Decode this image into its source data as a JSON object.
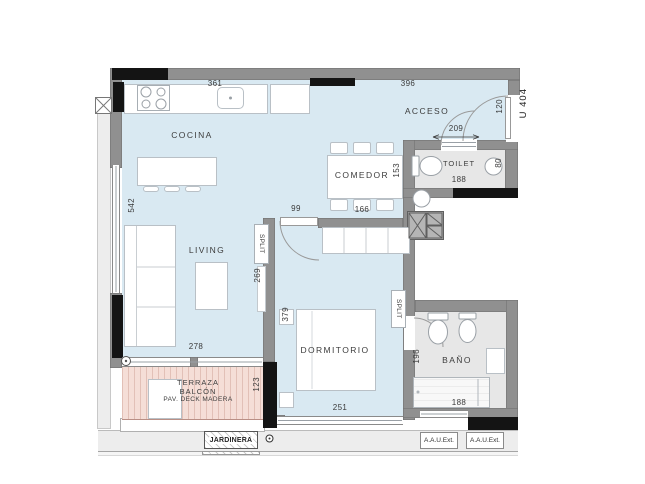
{
  "unit_label": "U 404",
  "rooms": {
    "cocina": "COCINA",
    "acceso": "ACCESO",
    "comedor": "COMEDOR",
    "toilet": "TOILET",
    "living": "LIVING",
    "dormitorio": "DORMITORIO",
    "bano": "BAÑO"
  },
  "terraza": {
    "line1": "TERRAZA",
    "line2": "BALCÓN",
    "line3": "PAV. DECK MADERA"
  },
  "exterior": {
    "jardinera": "JARDINERA",
    "aau_ext": "A.A.U.Ext."
  },
  "equipment": {
    "split": "SPLIT"
  },
  "dims": {
    "kitchen_top": "361",
    "acceso_top": "396",
    "acceso_width": "209",
    "entry_door": "120",
    "bedroom_door": "99",
    "comedor_width": "166",
    "comedor_depth": "153",
    "toilet_width": "188",
    "toilet_depth": "80",
    "living_height": "542",
    "wall_segment": "269",
    "living_width": "278",
    "dormitorio_depth": "379",
    "dormitorio_width": "251",
    "bano_depth": "196",
    "bano_width": "188",
    "terraza_depth": "123"
  },
  "colors": {
    "floor": "#d9e9f2",
    "service_floor": "#e7e7e7",
    "wall": "#909090",
    "wall_accent": "#141414",
    "terrace": "#f5ded7"
  }
}
